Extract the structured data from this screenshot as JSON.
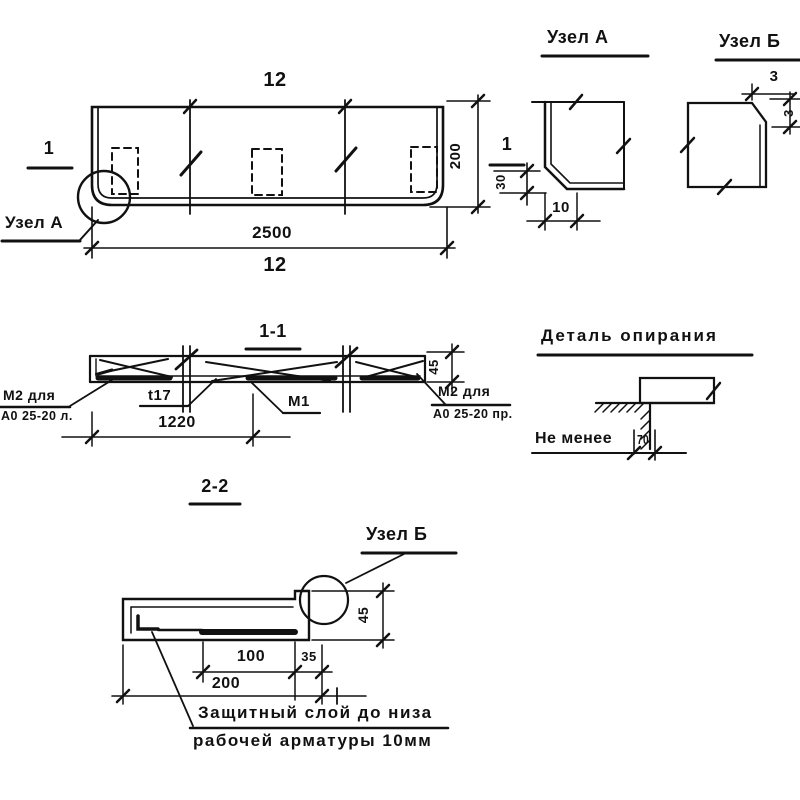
{
  "plan": {
    "dim_top": "12",
    "dim_length": "2500",
    "dim_bottom": "12",
    "dim_height": "200",
    "dim_flange": "30",
    "section_mark": "1",
    "callout_node_a": "Узел А"
  },
  "node_a": {
    "title": "Узел А",
    "dim_bottom": "10"
  },
  "node_b": {
    "title": "Узел Б",
    "dim_top": "3",
    "dim_side": "3"
  },
  "section11": {
    "title": "1-1",
    "mesh_left_line1": "М2 для",
    "mesh_left_line2": "А0 25-20 л.",
    "bar_label": "t17",
    "mesh_mid": "М1",
    "mesh_right_line1": "М2 для",
    "mesh_right_line2": "А0 25-20 пр.",
    "dim_span": "1220",
    "dim_depth": "45"
  },
  "support": {
    "title": "Деталь опирания",
    "note_text": "Не менее",
    "note_value": "70"
  },
  "section22": {
    "title": "2-2",
    "callout_node_b": "Узел Б",
    "dim_bar": "100",
    "dim_edge": "35",
    "dim_total": "200",
    "dim_depth": "45",
    "note_line1": "Защитный слой до низа",
    "note_line2": "рабочей арматуры 10мм"
  }
}
